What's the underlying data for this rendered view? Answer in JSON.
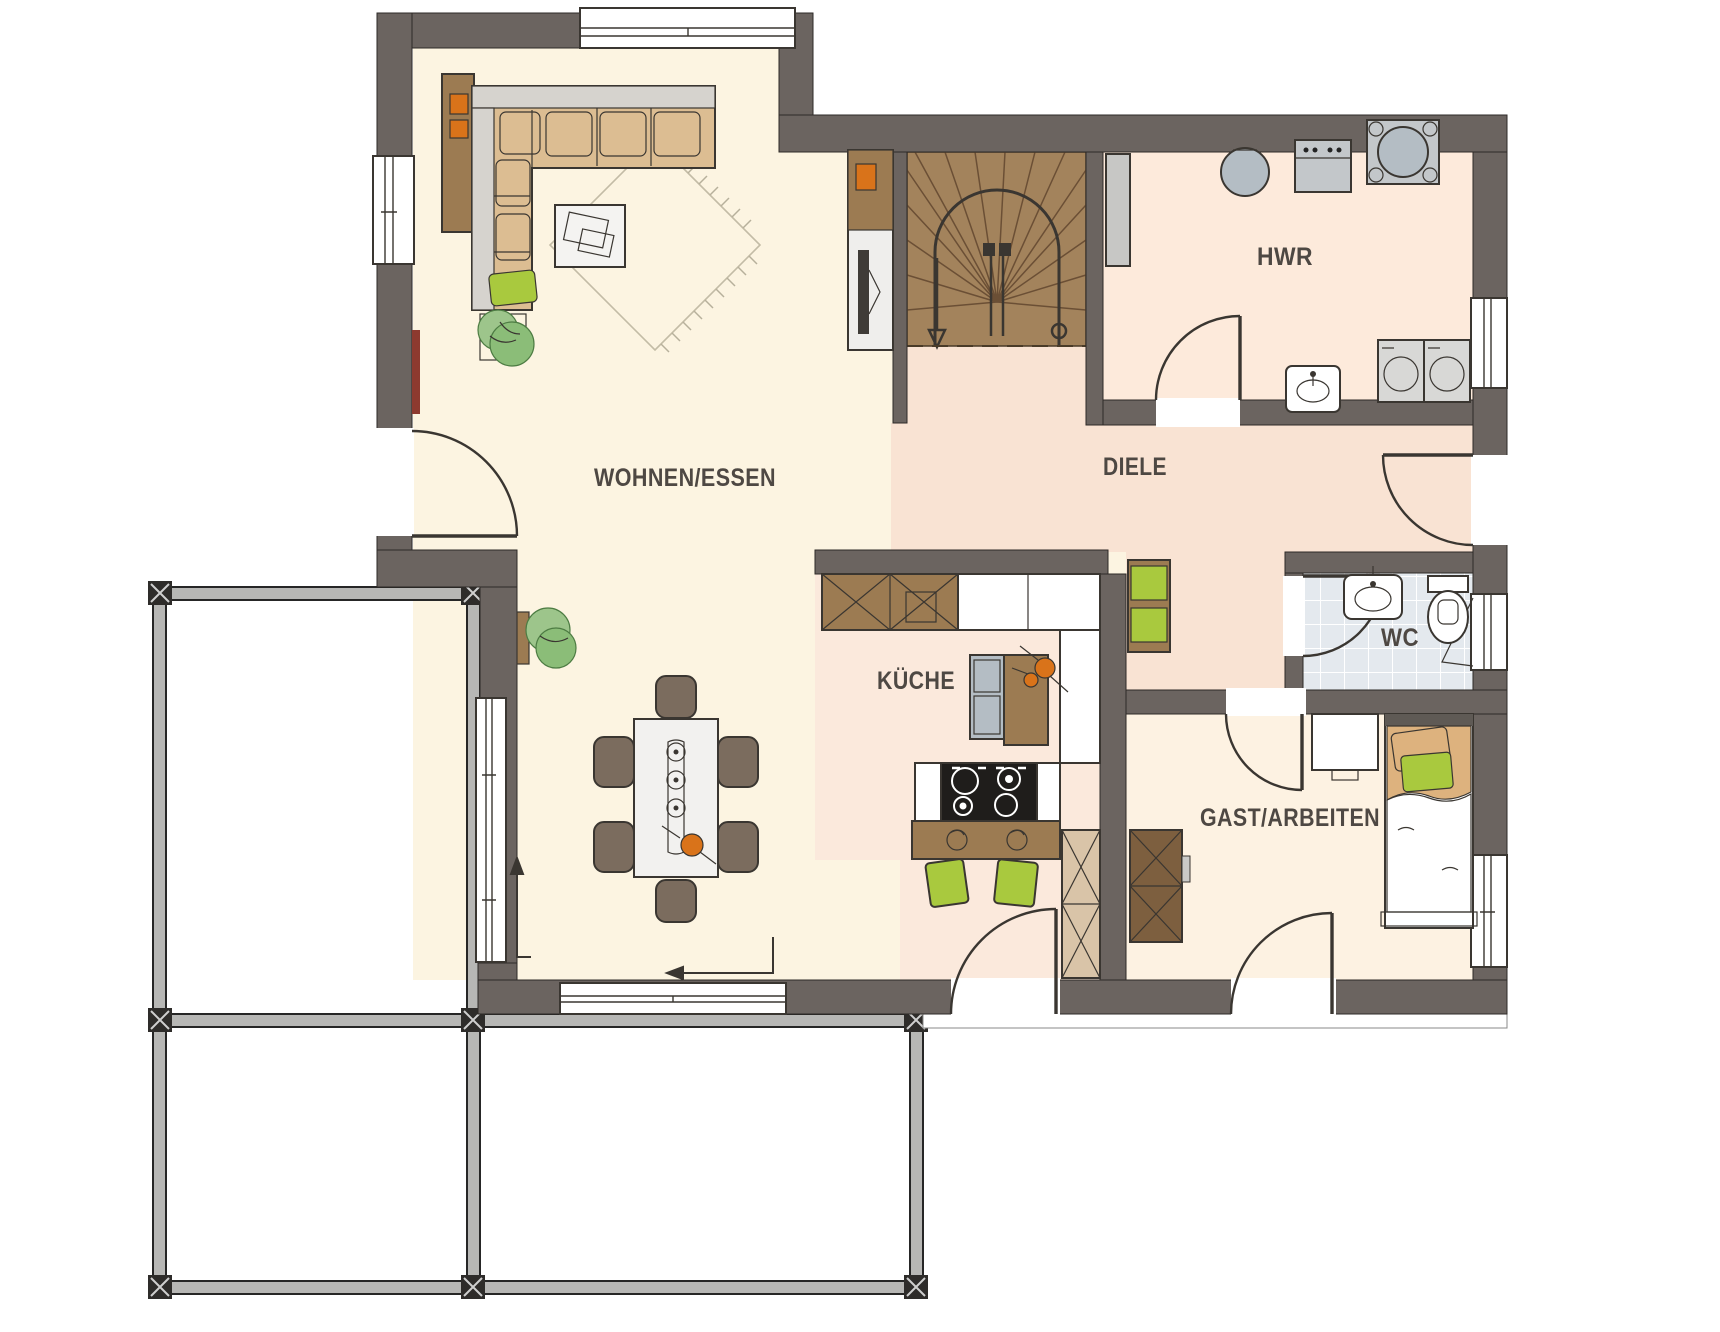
{
  "theme": {
    "wall": "#6b6460",
    "line": "#3a3631",
    "living": "#fcf4e1",
    "diele": "#f9e3d3",
    "kueche": "#fbe9dc",
    "hwr": "#fdeadb",
    "gast": "#fdf2e2",
    "wcTile": "#e4e9ee",
    "stairs": "#a3835c",
    "stairLine": "#6b4f35",
    "wood": "#9c7b52",
    "woodDark": "#7d5f3f",
    "woodLight": "#d9c4a8",
    "sofa": "#dcbd92",
    "upholstery": "#d6d3ce",
    "chair": "#7b6c5e",
    "green": "#a9c93e",
    "orange": "#d9731a",
    "appliance": "#c3c7ca",
    "steel": "#b4bdc4",
    "radiator": "#8d3a2f",
    "bedBlanket": "#ddb27e",
    "terrace": "#b7b7b5",
    "text": "#4e4843"
  },
  "plan": {
    "type": "floor-plan",
    "rooms": [
      {
        "id": "wohnen-essen",
        "label": "WOHNEN/ESSEN"
      },
      {
        "id": "diele",
        "label": "DIELE"
      },
      {
        "id": "hwr",
        "label": "HWR"
      },
      {
        "id": "kueche",
        "label": "KÜCHE"
      },
      {
        "id": "wc",
        "label": "WC"
      },
      {
        "id": "gast-arbeiten",
        "label": "GAST/ARBEITEN"
      }
    ],
    "icons": [
      "corner-sofa",
      "coffee-table",
      "rug",
      "plant",
      "tv-sideboard",
      "radiator",
      "dining-table",
      "dining-chair",
      "kitchen-cabinet",
      "counter",
      "fridge",
      "stove",
      "breakfast-bar",
      "bar-stool",
      "staircase",
      "wardrobe",
      "bench",
      "boiler",
      "heating-unit",
      "heat-pump",
      "utility-sink",
      "washer",
      "dryer",
      "wc-sink",
      "toilet",
      "desk",
      "single-bed",
      "terrace-pergola",
      "entrance-arrow",
      "door",
      "window"
    ]
  }
}
